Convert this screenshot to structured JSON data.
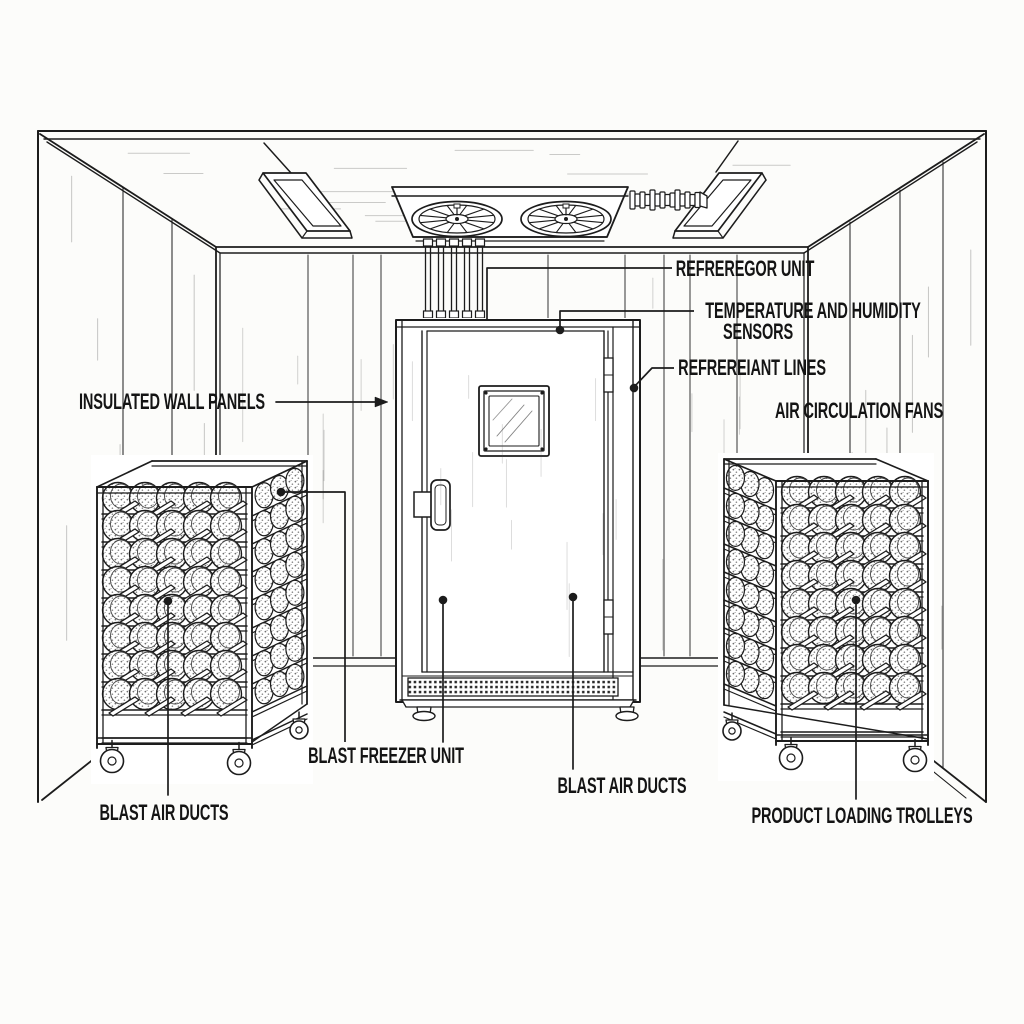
{
  "diagram": {
    "title_hidden": "",
    "background_color": "#fcfcfa",
    "line_color": "#1c1c1c",
    "labels": {
      "refrigerator_unit": "REFREREGOR UNIT",
      "temperature_humidity_line1": "TEMPERATURE AND HUMIDITY",
      "temperature_humidity_line2": "SENSORS",
      "refrigerant_lines": "REFREREIANT LINES",
      "air_circulation_fans": "AIR CIRCULATION FANS",
      "insulated_wall_panels": "INSULATED WALL PANELS",
      "blast_freezer_unit": "BLAST FREEZER UNIT",
      "blast_air_ducts_center": "BLAST AIR DUCTS",
      "blast_air_ducts_left": "BLAST AIR DUCTS",
      "product_loading_trolleys": "PRODUCT LOADING TROLLEYS"
    }
  }
}
